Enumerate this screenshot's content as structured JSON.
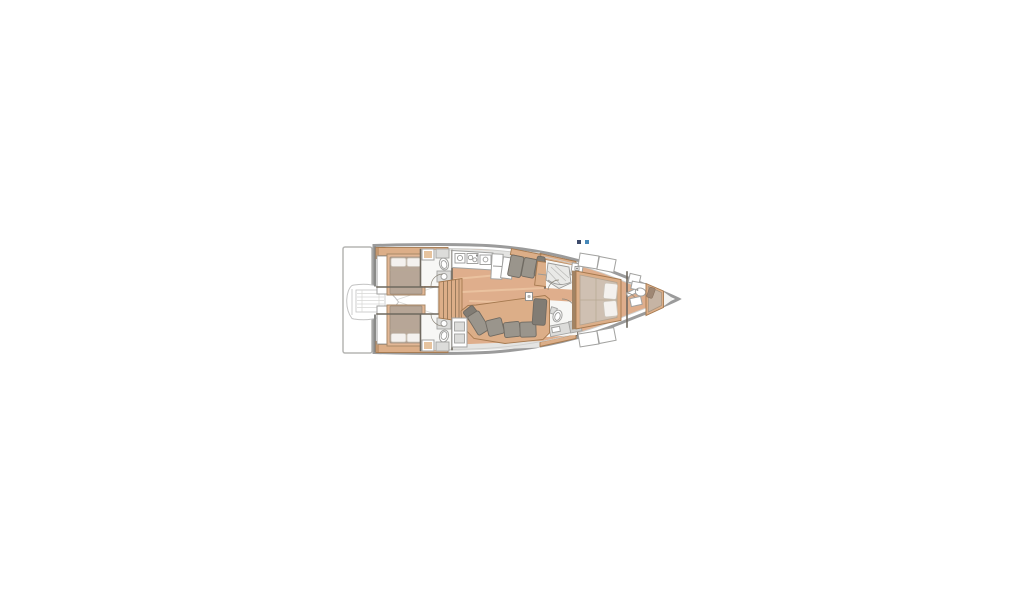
{
  "page": {
    "background": "#ffffff",
    "width": 1024,
    "height": 600
  },
  "image": {
    "kind": "yacht-interior-floorplan",
    "orientation": "bow-pointing-right",
    "visible_text": ""
  },
  "palette": {
    "hull_outline": "#9b9b9b",
    "hull_inner": "#cfcfcd",
    "floor_wood": "#dfae8c",
    "floor_streak": "#ecc5a2",
    "deck_gray": "#e4e4e2",
    "room_white": "#f7f7f5",
    "trim_wood": "#dcae88",
    "trim_wood_dark": "#a5794f",
    "wood_rail_dark": "#a18364",
    "bed_frame": "#e2b795",
    "mattress_gray": "#b7a697",
    "mattress_beige": "#cfc0b2",
    "berth_brown": "#c6b4a4",
    "berth_pillow": "#9f8774",
    "pillow": "#f4f1ee",
    "cushion": "#9a958c",
    "cushion_dark": "#817c74",
    "cushion_edge": "#6f6a62",
    "furniture_white": "#ffffff",
    "furniture_stroke": "#a2a2a0",
    "counter_gray": "#dcdcda",
    "counter_gray_dark": "#c9c9c7",
    "wall": "#6f695f",
    "fixture_stroke": "#9a9a98",
    "arc_line": "#8a8478",
    "dinghy_line": "#c3c3c3",
    "platform_stroke": "#b5b5b3",
    "marker_left": "#3d4a6b",
    "marker_right": "#4688b8"
  },
  "features": [
    "swim-platform",
    "transom",
    "tender-garage-dinghy",
    "aft-cabin-port",
    "aft-cabin-starboard",
    "aft-head-port",
    "aft-head-starboard",
    "companionway-stairs",
    "galley",
    "galley-stove",
    "galley-sink",
    "galley-island",
    "salon-settee-port",
    "salon-sofa-starboard",
    "chart-cabinet",
    "shower-room",
    "day-head",
    "mast-foot",
    "owner-cabin",
    "owner-bed",
    "forward-bulkhead",
    "bow-cabin",
    "bow-berth",
    "bow-sink"
  ]
}
